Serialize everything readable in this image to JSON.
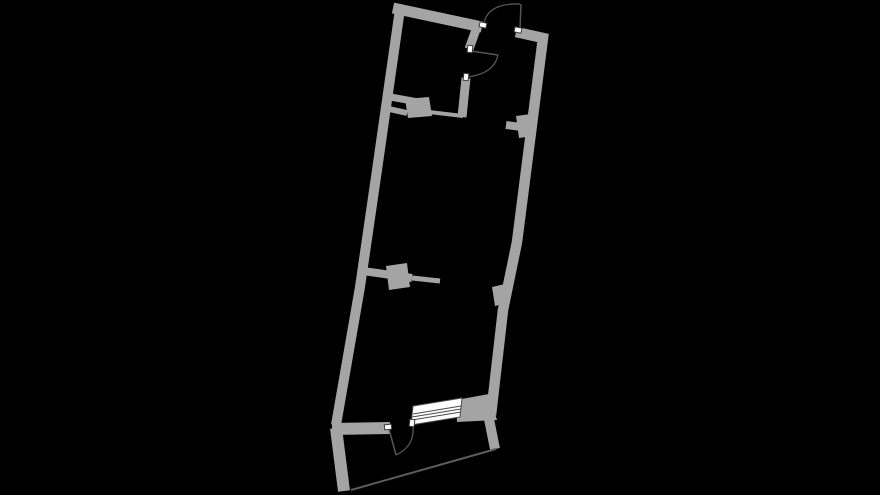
{
  "scene": {
    "width": 880,
    "height": 495,
    "background": "#000000"
  },
  "palette": {
    "wall": "#a4a4a4",
    "door_line": "#565656",
    "balcony_line": "#5d5d5d",
    "marker_fill": "#ffffff",
    "marker_stroke": "#3d3d3d",
    "window_fill": "#ffffff",
    "window_line": "#4c4c4c"
  },
  "floorplan": {
    "walls": [
      {
        "name": "top-wall",
        "width": 11,
        "points": [
          [
            393,
            8
          ],
          [
            482,
            27
          ]
        ]
      },
      {
        "name": "right-wall",
        "width": 10.5,
        "points": [
          [
            516,
            32
          ],
          [
            543,
            38
          ],
          [
            517,
            242
          ],
          [
            503,
            310
          ],
          [
            491,
            415
          ]
        ]
      },
      {
        "name": "left-wall",
        "width": 10,
        "points": [
          [
            400,
            9
          ],
          [
            377,
            170
          ],
          [
            360,
            287
          ],
          [
            336,
            425
          ]
        ]
      },
      {
        "name": "bottom-wall-left",
        "width": 12,
        "points": [
          [
            332,
            429
          ],
          [
            390,
            428
          ]
        ]
      },
      {
        "name": "room-partition-upper",
        "width": 9,
        "points": [
          [
            478,
            24
          ],
          [
            469,
            49
          ]
        ]
      },
      {
        "name": "room-partition-lower",
        "width": 9,
        "points": [
          [
            466,
            78
          ],
          [
            462,
            117
          ]
        ]
      },
      {
        "name": "room-bottom-bar-upper",
        "width": 7,
        "points": [
          [
            385,
            96
          ],
          [
            429,
            104
          ]
        ]
      },
      {
        "name": "room-bottom-bar-lower",
        "width": 6,
        "points": [
          [
            389,
            109
          ],
          [
            407,
            113
          ]
        ]
      },
      {
        "name": "room-bottom-thin-wall",
        "width": 4,
        "points": [
          [
            429,
            112
          ],
          [
            463,
            116
          ]
        ]
      },
      {
        "name": "left-stub-bar",
        "width": 8,
        "points": [
          [
            363,
            271
          ],
          [
            412,
            278
          ]
        ]
      },
      {
        "name": "left-stub-bar-thin",
        "width": 5,
        "points": [
          [
            412,
            278
          ],
          [
            440,
            281
          ]
        ]
      },
      {
        "name": "right-stub-bar",
        "width": 8,
        "points": [
          [
            506,
            125
          ],
          [
            529,
            128
          ]
        ]
      },
      {
        "name": "balcony-left-wall",
        "width": 12,
        "points": [
          [
            336,
            428
          ],
          [
            344,
            491
          ]
        ]
      },
      {
        "name": "balcony-right-wall",
        "width": 10,
        "points": [
          [
            489,
            419
          ],
          [
            495,
            449
          ]
        ]
      }
    ],
    "blocks": [
      {
        "name": "room-bottom-column",
        "points": [
          [
            405,
            99
          ],
          [
            429,
            97
          ],
          [
            432,
            116
          ],
          [
            408,
            118
          ]
        ]
      },
      {
        "name": "left-stub-column",
        "points": [
          [
            386,
            266
          ],
          [
            407,
            263
          ],
          [
            410,
            287
          ],
          [
            389,
            290
          ]
        ]
      },
      {
        "name": "right-stub-column",
        "points": [
          [
            516,
            116
          ],
          [
            531,
            114
          ],
          [
            534,
            136
          ],
          [
            519,
            138
          ]
        ]
      },
      {
        "name": "right-wall-pier",
        "points": [
          [
            492,
            287
          ],
          [
            505,
            284
          ],
          [
            508,
            303
          ],
          [
            495,
            306
          ]
        ]
      },
      {
        "name": "bottom-right-wall-block",
        "points": [
          [
            456,
            400
          ],
          [
            489,
            394
          ],
          [
            497,
            420
          ],
          [
            457,
            422
          ]
        ]
      }
    ],
    "doors": [
      {
        "name": "entry-door",
        "leaf": [
          [
            520,
            29
          ],
          [
            521,
            4
          ]
        ],
        "arc": "M 484 23 Q 488 3 520 4",
        "jambs": [
          [
            483,
            25,
            12
          ],
          [
            518,
            30,
            12
          ]
        ]
      },
      {
        "name": "room-door",
        "leaf": [
          [
            471,
            51
          ],
          [
            498,
            55
          ]
        ],
        "arc": "M 498 55 Q 494 74 467 77",
        "jambs": [
          [
            470,
            49,
            96
          ],
          [
            466,
            77,
            96
          ]
        ]
      },
      {
        "name": "balcony-door",
        "leaf": [
          [
            389,
            429
          ],
          [
            396,
            455
          ]
        ],
        "arc": "M 413 426 Q 415 446 396 455",
        "jambs": [
          [
            388,
            427,
            -5
          ]
        ]
      }
    ],
    "window": {
      "name": "balcony-window",
      "frame": [
        [
          411,
          425
        ],
        [
          413,
          406
        ],
        [
          462,
          398
        ],
        [
          460,
          417
        ]
      ],
      "glazing": [
        [
          [
            412,
            420
          ],
          [
            461,
            412
          ]
        ],
        [
          [
            412,
            417
          ],
          [
            461,
            409
          ]
        ],
        [
          [
            413,
            414
          ],
          [
            461,
            406
          ]
        ]
      ],
      "marker": [
        412,
        423,
        96
      ]
    },
    "balcony_edge": {
      "name": "balcony-front-edge",
      "width": 2,
      "points": [
        [
          351,
          490
        ],
        [
          496,
          449
        ]
      ]
    }
  }
}
